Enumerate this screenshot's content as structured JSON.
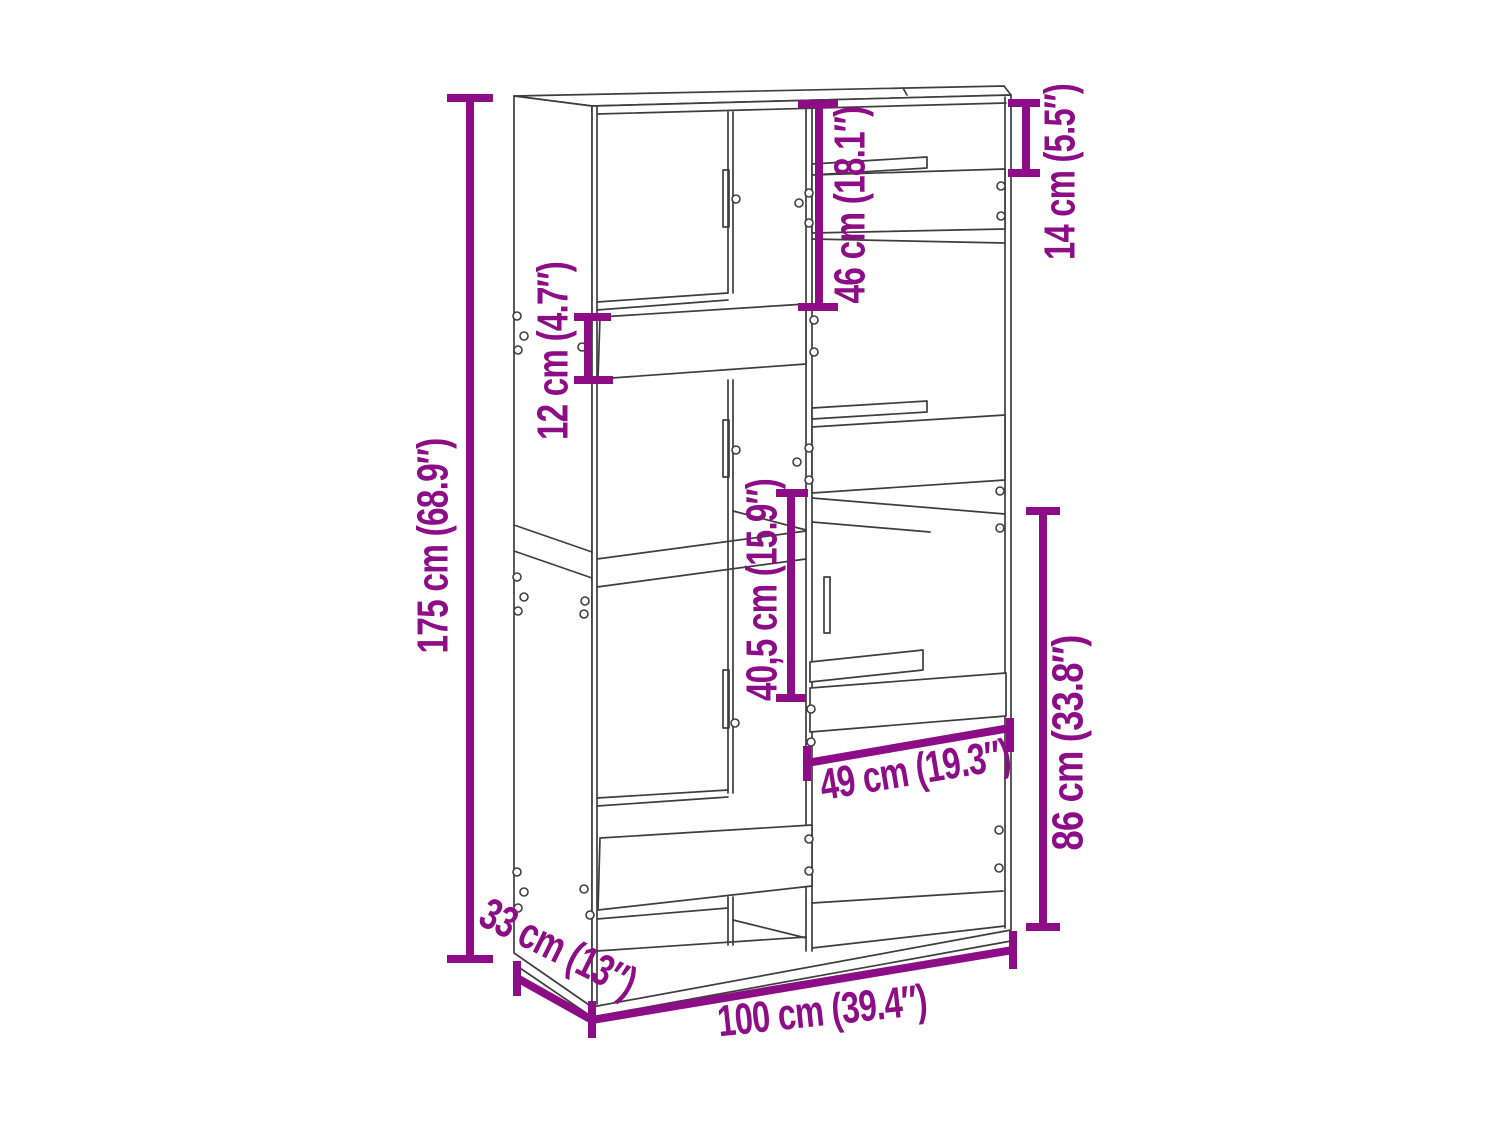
{
  "diagram": {
    "background_color": "#ffffff",
    "line_color": "#3e3e3e",
    "accent_color": "#8D0D87"
  },
  "dimensions": {
    "height": {
      "label": "175 cm (68.9″)",
      "cm": "175",
      "inches": "68.9"
    },
    "shelf_front": {
      "label": "12 cm (4.7″)",
      "cm": "12",
      "inches": "4.7"
    },
    "upper_left": {
      "label": "46 cm (18.1″)",
      "cm": "46",
      "inches": "18.1"
    },
    "upper_right": {
      "label": "14 cm (5.5″)",
      "cm": "14",
      "inches": "5.5"
    },
    "middle_opening": {
      "label": "40,5 cm (15.9″)",
      "cm": "40,5",
      "inches": "15.9"
    },
    "inner_width": {
      "label": "49 cm (19.3″)",
      "cm": "49",
      "inches": "19.3"
    },
    "lower_section": {
      "label": "86 cm (33.8″)",
      "cm": "86",
      "inches": "33.8"
    },
    "depth": {
      "label": "33 cm (13″)",
      "cm": "33",
      "inches": "13"
    },
    "width": {
      "label": "100 cm (39.4″)",
      "cm": "100",
      "inches": "39.4"
    }
  }
}
